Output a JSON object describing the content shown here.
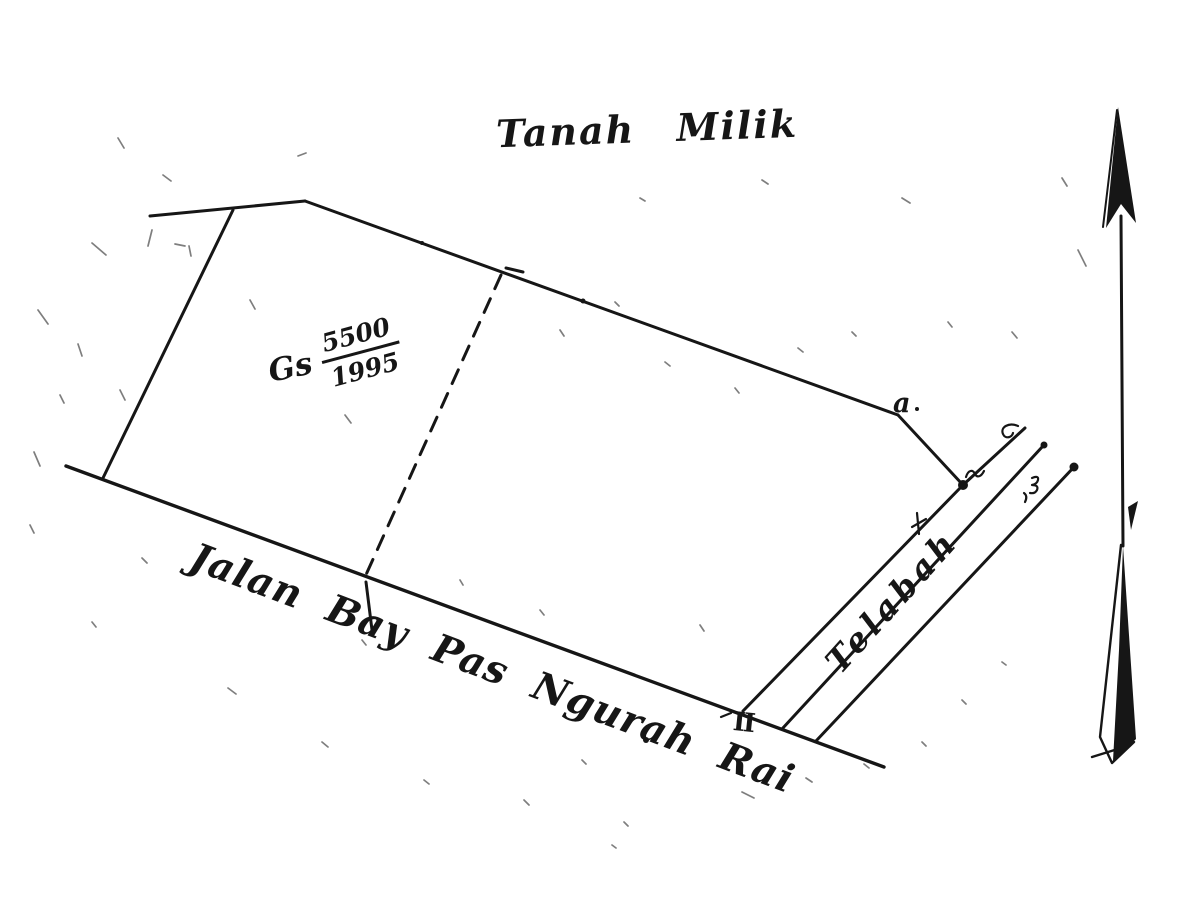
{
  "page": {
    "ink_color": "#161616",
    "paper_color": "#ffffff"
  },
  "title": "Tanah Milik",
  "parcel": {
    "registration_prefix": "Gs",
    "registration_number": "5500",
    "registration_year": "1995",
    "corner_point_label": "a",
    "road_section_marker": "II"
  },
  "road": {
    "name": "Jalan Bay Pas Ngurah Rai"
  },
  "water_channel": {
    "name": "Telabah"
  },
  "icons": {
    "north_arrow": "north-arrow"
  }
}
